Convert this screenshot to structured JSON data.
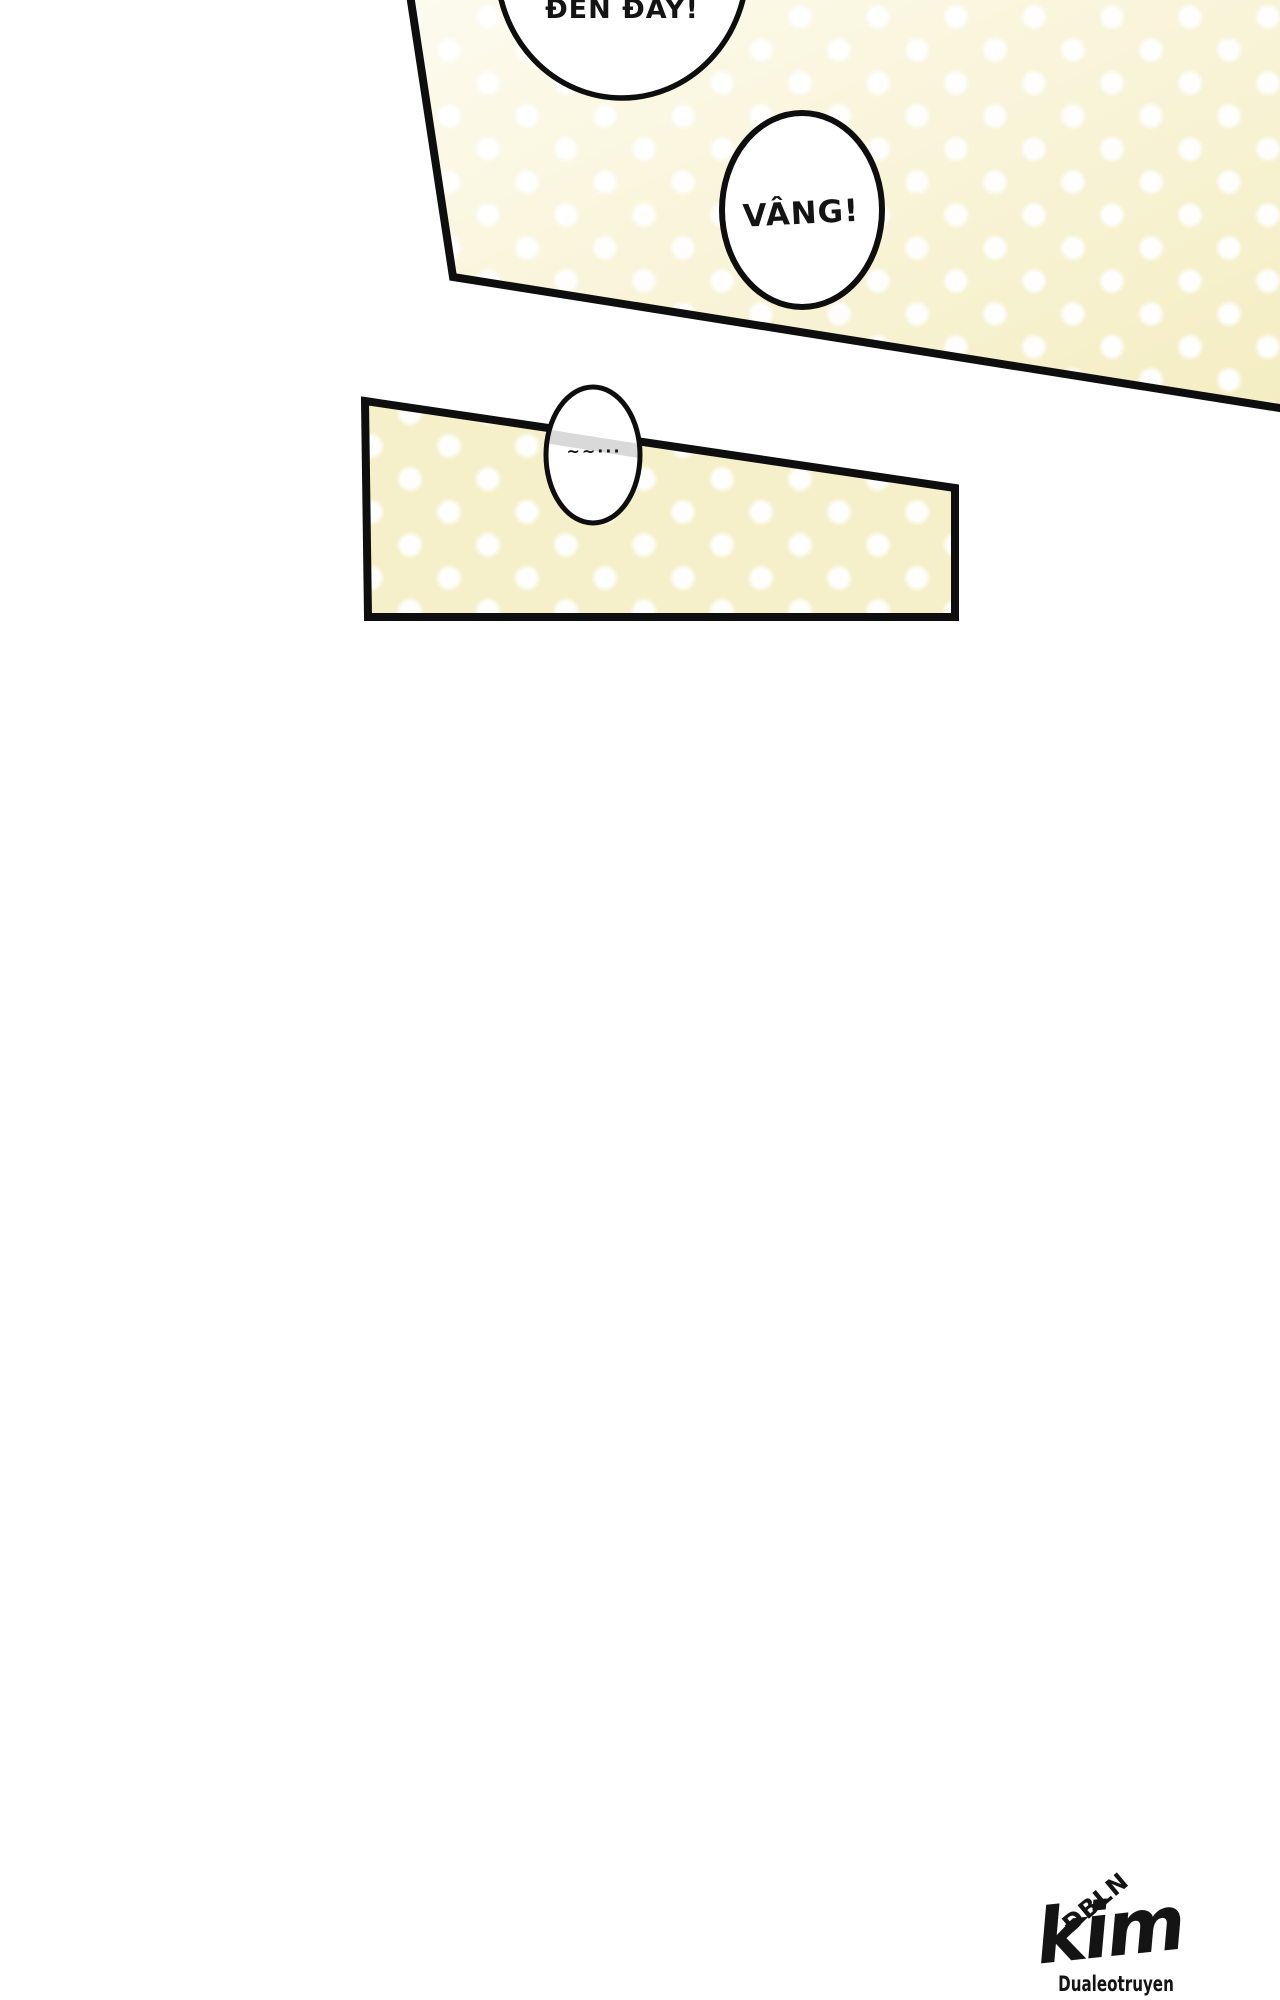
{
  "colors": {
    "line": "#0e0e0e",
    "text": "#141414",
    "bubble_fill": "#ffffff",
    "panel1_grad_start": "#fdfbef",
    "panel1_grad_end": "#f4edc2",
    "panel2_fill": "#f6f0ca",
    "dot": "#ffffff",
    "border_gray_through_bubble": "#d9d9d9"
  },
  "panel1": {
    "bubbles": [
      {
        "text": "ĐẾN ĐÂY!"
      },
      {
        "text": "VÂNG!"
      }
    ]
  },
  "panel2": {
    "bubble": {
      "text": "~~···"
    }
  },
  "watermark": {
    "top": "ĐBLN",
    "name": "kim",
    "bottom": "Dualeotruyen"
  }
}
